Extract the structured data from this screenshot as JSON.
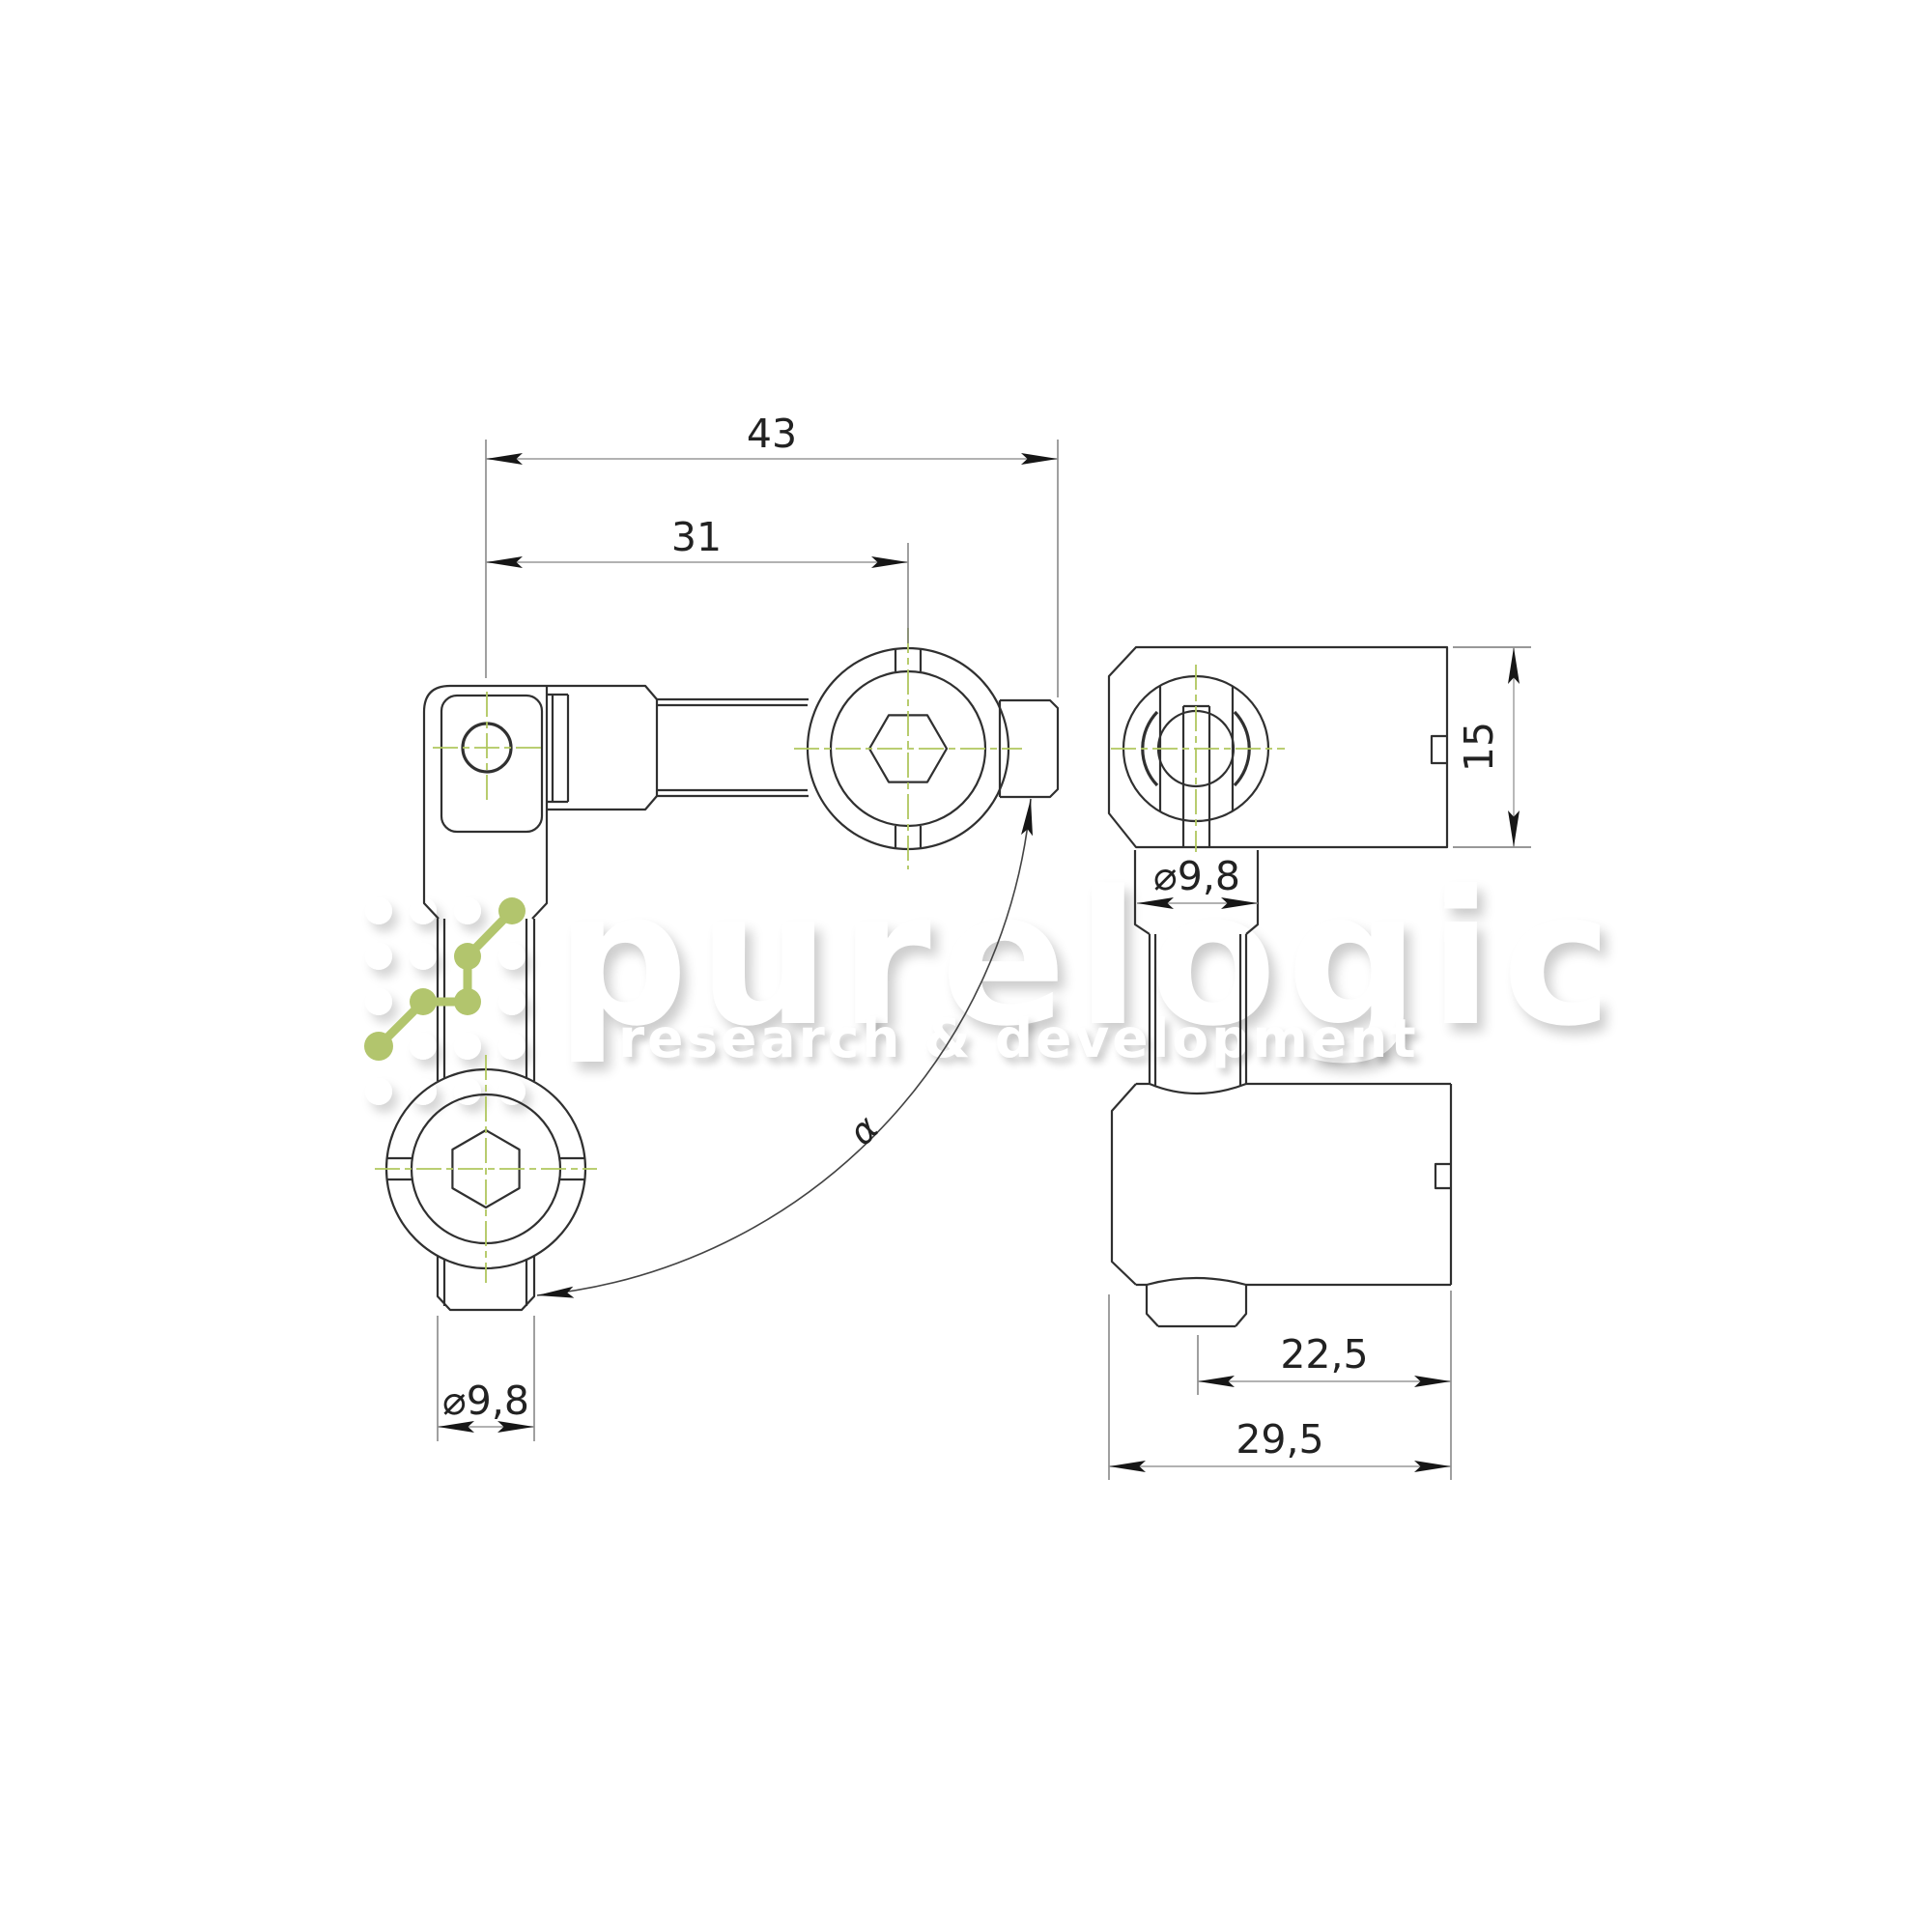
{
  "drawing_type": "technical-drawing",
  "dimensions": {
    "overall_length": "43",
    "axis_to_ball": "31",
    "housing_height": "15",
    "stud_diameter_front": "⌀9,8",
    "stud_diameter_side": "⌀9,8",
    "axis_to_edge": "22,5",
    "housing_width": "29,5",
    "swivel_angle": "α"
  },
  "watermark": {
    "brand": "purelogic",
    "tagline": "research & development"
  },
  "colors": {
    "background": "#ffffff",
    "edge_line": "#303030",
    "dimension_line": "#999999",
    "extension_line": "#777777",
    "arrow": "#161616",
    "dimension_text": "#222222",
    "centerline_green": "#b0c75f",
    "logo_green": "#b2c56d",
    "watermark_white": "#ffffff"
  }
}
